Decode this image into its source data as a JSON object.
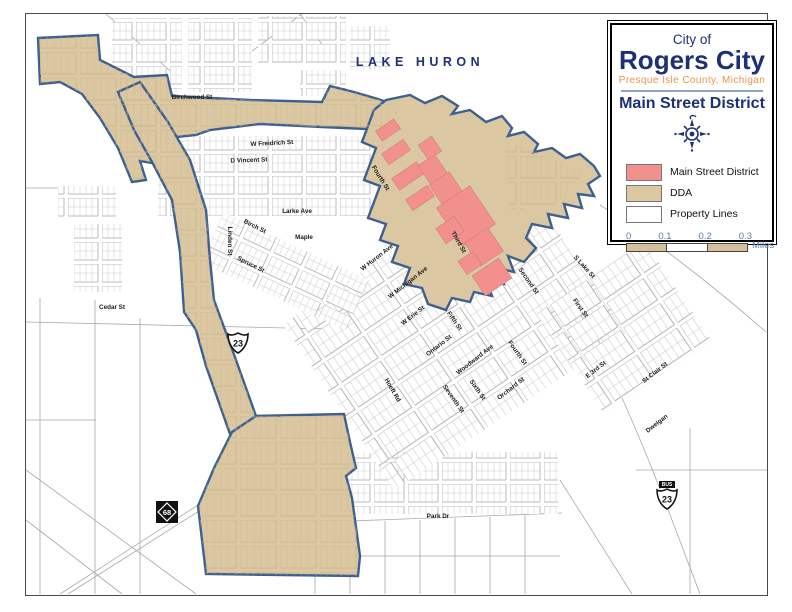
{
  "panel": {
    "title_small": "City of",
    "title_large": "Rogers City",
    "subtitle": "Presque Isle County, Michigan",
    "district_title": "Main Street District",
    "legend": [
      {
        "label": "Main Street District",
        "color": "#f2908d"
      },
      {
        "label": "DDA",
        "color": "#dbc7a1"
      },
      {
        "label": "Property Lines",
        "color": "#ffffff"
      }
    ],
    "scale": {
      "ticks": [
        "0",
        "0.1",
        "0.2",
        "0.3"
      ],
      "unit": "Miles"
    }
  },
  "map": {
    "lake_label": "LAKE HURON",
    "colors": {
      "main_street_district": "#f2908d",
      "dda_fill": "#dbc7a1",
      "dda_boundary": "#3d6090",
      "property_lines": "#b0b0b0",
      "navy_text": "#1d3076",
      "orange_text": "#e8954f"
    },
    "shields": {
      "us23": "23",
      "us23bus_banner": "BUS",
      "us23bus": "23",
      "m68": "68"
    },
    "streets": [
      {
        "label": "Birchwood St"
      },
      {
        "label": "W Freidrich St"
      },
      {
        "label": "D Vincent St"
      },
      {
        "label": "Larke Ave"
      },
      {
        "label": "Birch St"
      },
      {
        "label": "Linden St"
      },
      {
        "label": "Maple"
      },
      {
        "label": "Spruce St"
      },
      {
        "label": "Cedar St"
      },
      {
        "label": "Fourth St"
      },
      {
        "label": "Third St"
      },
      {
        "label": "W Huron Ave"
      },
      {
        "label": "W Michigan Ave"
      },
      {
        "label": "Second St"
      },
      {
        "label": "S Lake St"
      },
      {
        "label": "First St"
      },
      {
        "label": "W Erie St"
      },
      {
        "label": "Fifth St"
      },
      {
        "label": "Ontario St"
      },
      {
        "label": "Woodward Ave"
      },
      {
        "label": "Fourth St"
      },
      {
        "label": "Hoeft Rd"
      },
      {
        "label": "Seventh St"
      },
      {
        "label": "Sixth St"
      },
      {
        "label": "Orchard St"
      },
      {
        "label": "E 3rd St"
      },
      {
        "label": "St Clair St"
      },
      {
        "label": "Dwelgan"
      },
      {
        "label": "Park Dr"
      }
    ]
  }
}
